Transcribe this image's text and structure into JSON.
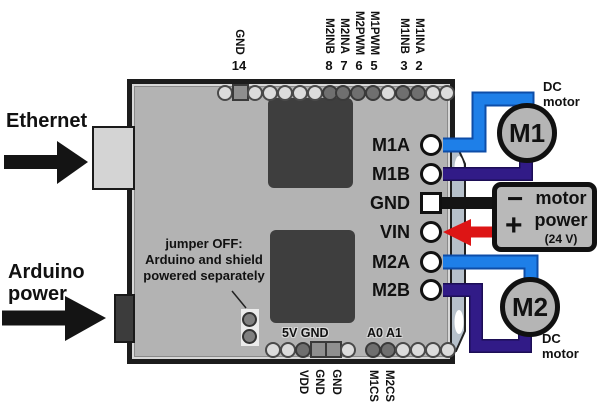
{
  "colors": {
    "wire_blue": "#1e7fe8",
    "wire_blue_edge": "#0d4da8",
    "wire_purple": "#311b87",
    "wire_purple_edge": "#1c0e55",
    "wire_black": "#141414",
    "wire_red": "#dd1515",
    "arrow_black": "#141414",
    "board_gray": "#b3b3b3",
    "chip_gray": "#3e3e3e",
    "strip_gray": "#b6c0ca"
  },
  "left_annotations": {
    "ethernet": "Ethernet",
    "arduino_line1": "Arduino",
    "arduino_line2": "power"
  },
  "board": {
    "jumper_note_line1": "jumper OFF:",
    "jumper_note_line2": "Arduino and shield",
    "jumper_note_line3": "powered separately",
    "silk_5v_gnd": "5V GND",
    "silk_a0_a1": "A0 A1"
  },
  "top_pins": [
    {
      "signal": "GND",
      "arduino_pin": "14"
    },
    {
      "signal": "M2INB",
      "arduino_pin": "8"
    },
    {
      "signal": "M2INA",
      "arduino_pin": "7"
    },
    {
      "signal": "M2PWM",
      "arduino_pin": "6"
    },
    {
      "signal": "M1PWM",
      "arduino_pin": "5"
    },
    {
      "signal": "M1INB",
      "arduino_pin": "3"
    },
    {
      "signal": "M1INA",
      "arduino_pin": "2"
    }
  ],
  "bottom_pins": [
    {
      "signal": "VDD"
    },
    {
      "signal": "GND"
    },
    {
      "signal": "GND"
    },
    {
      "signal": "M1CS"
    },
    {
      "signal": "M2CS"
    }
  ],
  "right_terminals": [
    {
      "label": "M1A"
    },
    {
      "label": "M1B"
    },
    {
      "label": "GND"
    },
    {
      "label": "VIN"
    },
    {
      "label": "M2A"
    },
    {
      "label": "M2B"
    }
  ],
  "motors": [
    {
      "id": "M1",
      "caption_line1": "DC",
      "caption_line2": "motor"
    },
    {
      "id": "M2",
      "caption_line1": "DC",
      "caption_line2": "motor"
    }
  ],
  "power_supply": {
    "minus": "−",
    "plus": "+",
    "name_line1": "motor",
    "name_line2": "power",
    "voltage": "(24 V)"
  }
}
